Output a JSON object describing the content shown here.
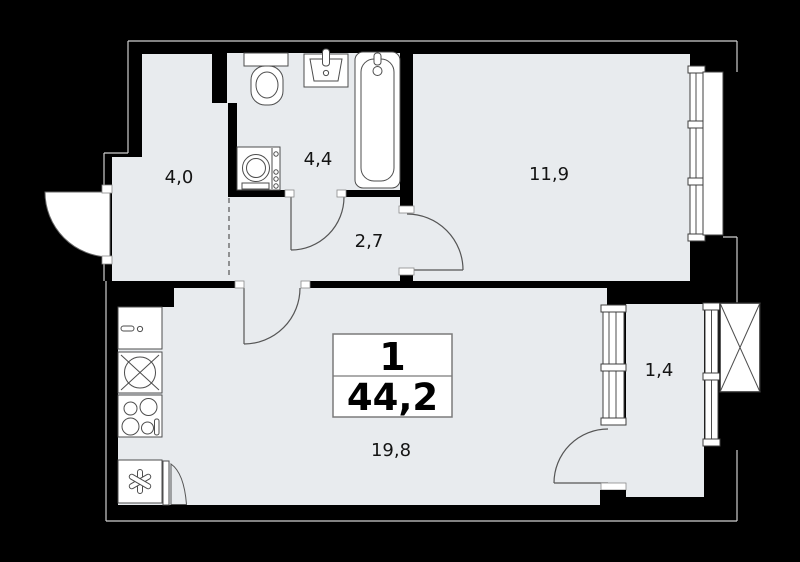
{
  "title": "apartment-floor-plan",
  "unit_card": {
    "rooms_count": "1",
    "total_area": "44,2"
  },
  "rooms": [
    {
      "name": "hallway",
      "area": "4,0"
    },
    {
      "name": "bathroom",
      "area": "4,4"
    },
    {
      "name": "corridor",
      "area": "2,7"
    },
    {
      "name": "bedroom",
      "area": "11,9"
    },
    {
      "name": "living-kitchen",
      "area": "19,8"
    },
    {
      "name": "balcony",
      "area": "1,4"
    }
  ],
  "fixtures": [
    "toilet",
    "washbasin",
    "bathtub",
    "washing-machine",
    "kitchen-sink",
    "hob",
    "stove",
    "refrigerator"
  ],
  "features": [
    "entrance-door",
    "bathroom-door",
    "bedroom-door",
    "living-room-door",
    "balcony-door",
    "bedroom-window",
    "balcony-windows",
    "ventilation-shaft"
  ],
  "colors": {
    "background": "#000000",
    "floor": "#e8ebee",
    "fixture_fill": "#ffffff",
    "wall_line": "#4d4d4d",
    "outer_line": "#cfcfcf",
    "label_text": "#141414"
  }
}
